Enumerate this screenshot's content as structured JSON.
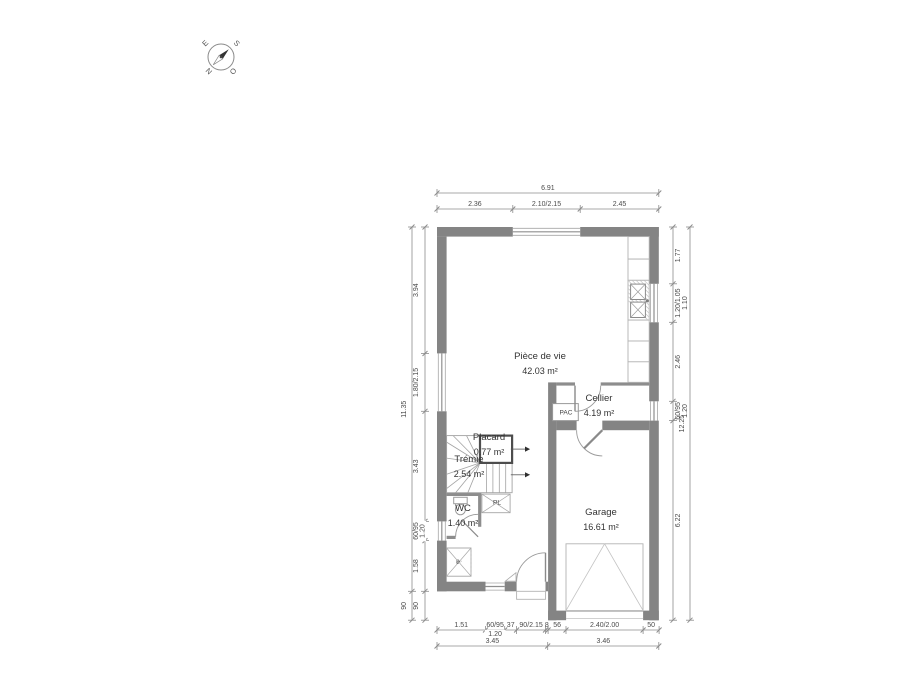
{
  "compass": {
    "east": "E",
    "south": "S",
    "west": "O",
    "north": "N"
  },
  "rooms": {
    "piece_de_vie": {
      "name": "Pièce de vie",
      "area": "42.03 m²"
    },
    "cellier": {
      "name": "Cellier",
      "area": "4.19 m²"
    },
    "placard": {
      "name": "Placard",
      "area": "0.77 m²"
    },
    "tremie": {
      "name": "Trémie",
      "area": "2.54 m²"
    },
    "wc": {
      "name": "WC",
      "area": "1.40 m²"
    },
    "garage": {
      "name": "Garage",
      "area": "16.61 m²"
    }
  },
  "fixtures": {
    "pac": "PAC",
    "pl": "PL",
    "elec": "él."
  },
  "dimensions": {
    "top_outer": [
      {
        "label": "6.91",
        "len": 6.91
      }
    ],
    "top_inner": [
      {
        "label": "2.36",
        "len": 2.36
      },
      {
        "label": "2.10/2.15",
        "len": 2.1
      },
      {
        "label": "2.45",
        "len": 2.45
      }
    ],
    "left_outer": [
      {
        "label": "11.35",
        "len": 11.35
      },
      {
        "label": "90",
        "len": 0.9
      }
    ],
    "left_inner": [
      {
        "label": "3.94",
        "len": 3.94
      },
      {
        "label": "1.80/2.15",
        "len": 1.8
      },
      {
        "label": "3.43",
        "len": 3.43
      },
      {
        "label": "60/95",
        "sub": "1.20",
        "len": 0.6
      },
      {
        "label": "1.58",
        "len": 1.58
      },
      {
        "label": "90",
        "len": 0.9
      }
    ],
    "right_inner": [
      {
        "label": "1.77",
        "len": 1.77
      },
      {
        "label": "1.20/1.05",
        "sub": "1.10",
        "len": 1.2
      },
      {
        "label": "2.46",
        "len": 2.46
      },
      {
        "label": "60/95",
        "sub": "1.20",
        "len": 0.6
      },
      {
        "label": "6.22",
        "len": 6.22
      }
    ],
    "right_outer": [
      {
        "label": "12.25",
        "len": 12.25
      }
    ],
    "bottom_inner": [
      {
        "label": "1.51",
        "len": 1.51
      },
      {
        "label": "60/95",
        "sub": "1.20",
        "len": 0.6
      },
      {
        "label": "37",
        "len": 0.37
      },
      {
        "label": "90/2.15",
        "len": 0.9
      },
      {
        "label": "8",
        "len": 0.08
      },
      {
        "label": "56",
        "len": 0.56
      },
      {
        "label": "2.40/2.00",
        "len": 2.4
      },
      {
        "label": "50",
        "len": 0.5
      }
    ],
    "bottom_outer": [
      {
        "label": "3.45",
        "len": 3.45
      },
      {
        "label": "3.46",
        "len": 3.46
      }
    ]
  },
  "colors": {
    "wall": "#848484",
    "partition": "#8d8d8d",
    "dim_line": "#8c8c8c",
    "dim_text": "#4a4a4a",
    "room_text": "#333333",
    "fixture_line": "#a6a6a6",
    "door_line": "#9a9a9a",
    "stair_line": "#a3a3a3"
  }
}
